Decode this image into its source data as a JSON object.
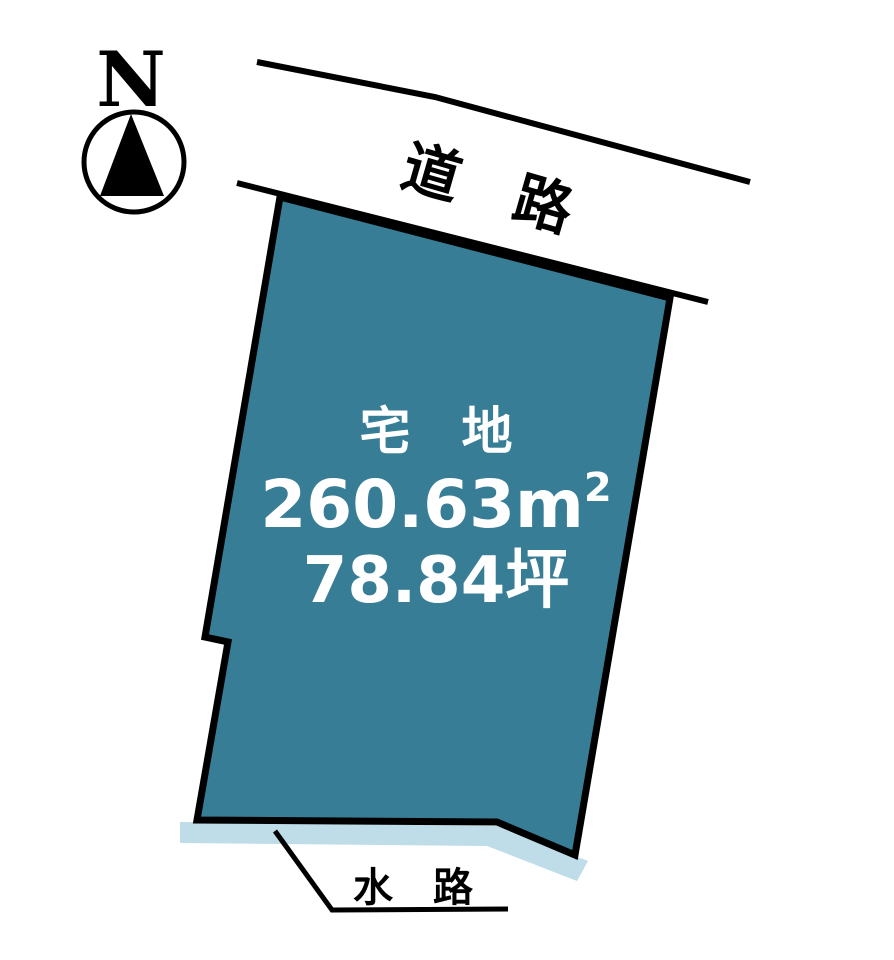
{
  "compass": {
    "north_label": "N"
  },
  "road": {
    "label": "道　路"
  },
  "parcel": {
    "type_label": "宅　地",
    "area_value": "260.63",
    "area_unit_base": "m",
    "area_unit_sup": "2",
    "tsubo_value": "78.84",
    "tsubo_unit": "坪"
  },
  "waterway": {
    "label": "水　路"
  },
  "colors": {
    "background": "#ffffff",
    "parcel_fill": "#377d96",
    "parcel_stroke": "#000000",
    "waterway_fill": "#bedde9",
    "line_color": "#000000",
    "parcel_text": "#ffffff",
    "label_text": "#000000"
  }
}
